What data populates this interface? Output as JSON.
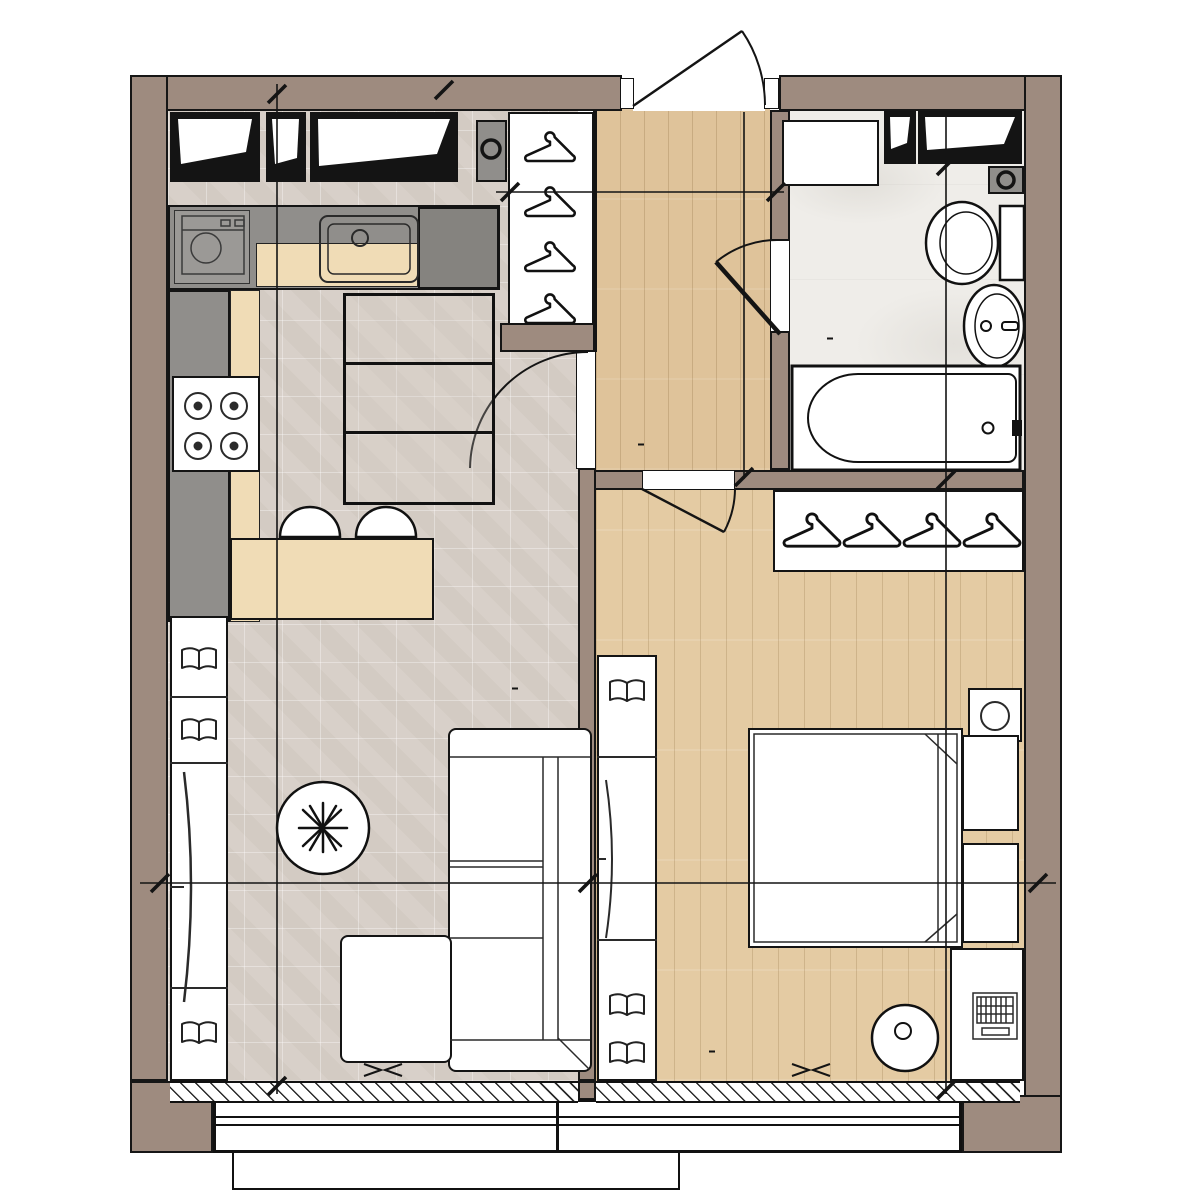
{
  "unit_info": {
    "rooms_count": "1",
    "stat_values": [
      "13,9",
      "41,5",
      "41,5"
    ]
  },
  "room_areas": {
    "living": "19,0 м²",
    "bedroom": "13,9 м²",
    "bathroom": "4,2 м²",
    "hallway": "4,4 м²"
  },
  "appliance_labels": {
    "washing_machine": "Ст.М.",
    "dishwasher": "ПМ"
  },
  "dimensions": {
    "hallway_width": "1 950",
    "hallway_length": "2 600",
    "bathroom_length": "2 265",
    "bathtub_length": "1 740",
    "living_length": "6 560",
    "living_width": "3 000",
    "bedroom_width": "3 130",
    "bedroom_length": "4 430"
  },
  "colors": {
    "wall": "#9e8b7f",
    "tile_floor": "#d7cfc7",
    "hall_wood": "#dfc39a",
    "bedroom_wood": "#e4cba3",
    "bath_floor": "#efede9",
    "counter_gray": "#908e8b",
    "cabinet_wood": "#f0dcb6",
    "line": "#141414"
  }
}
